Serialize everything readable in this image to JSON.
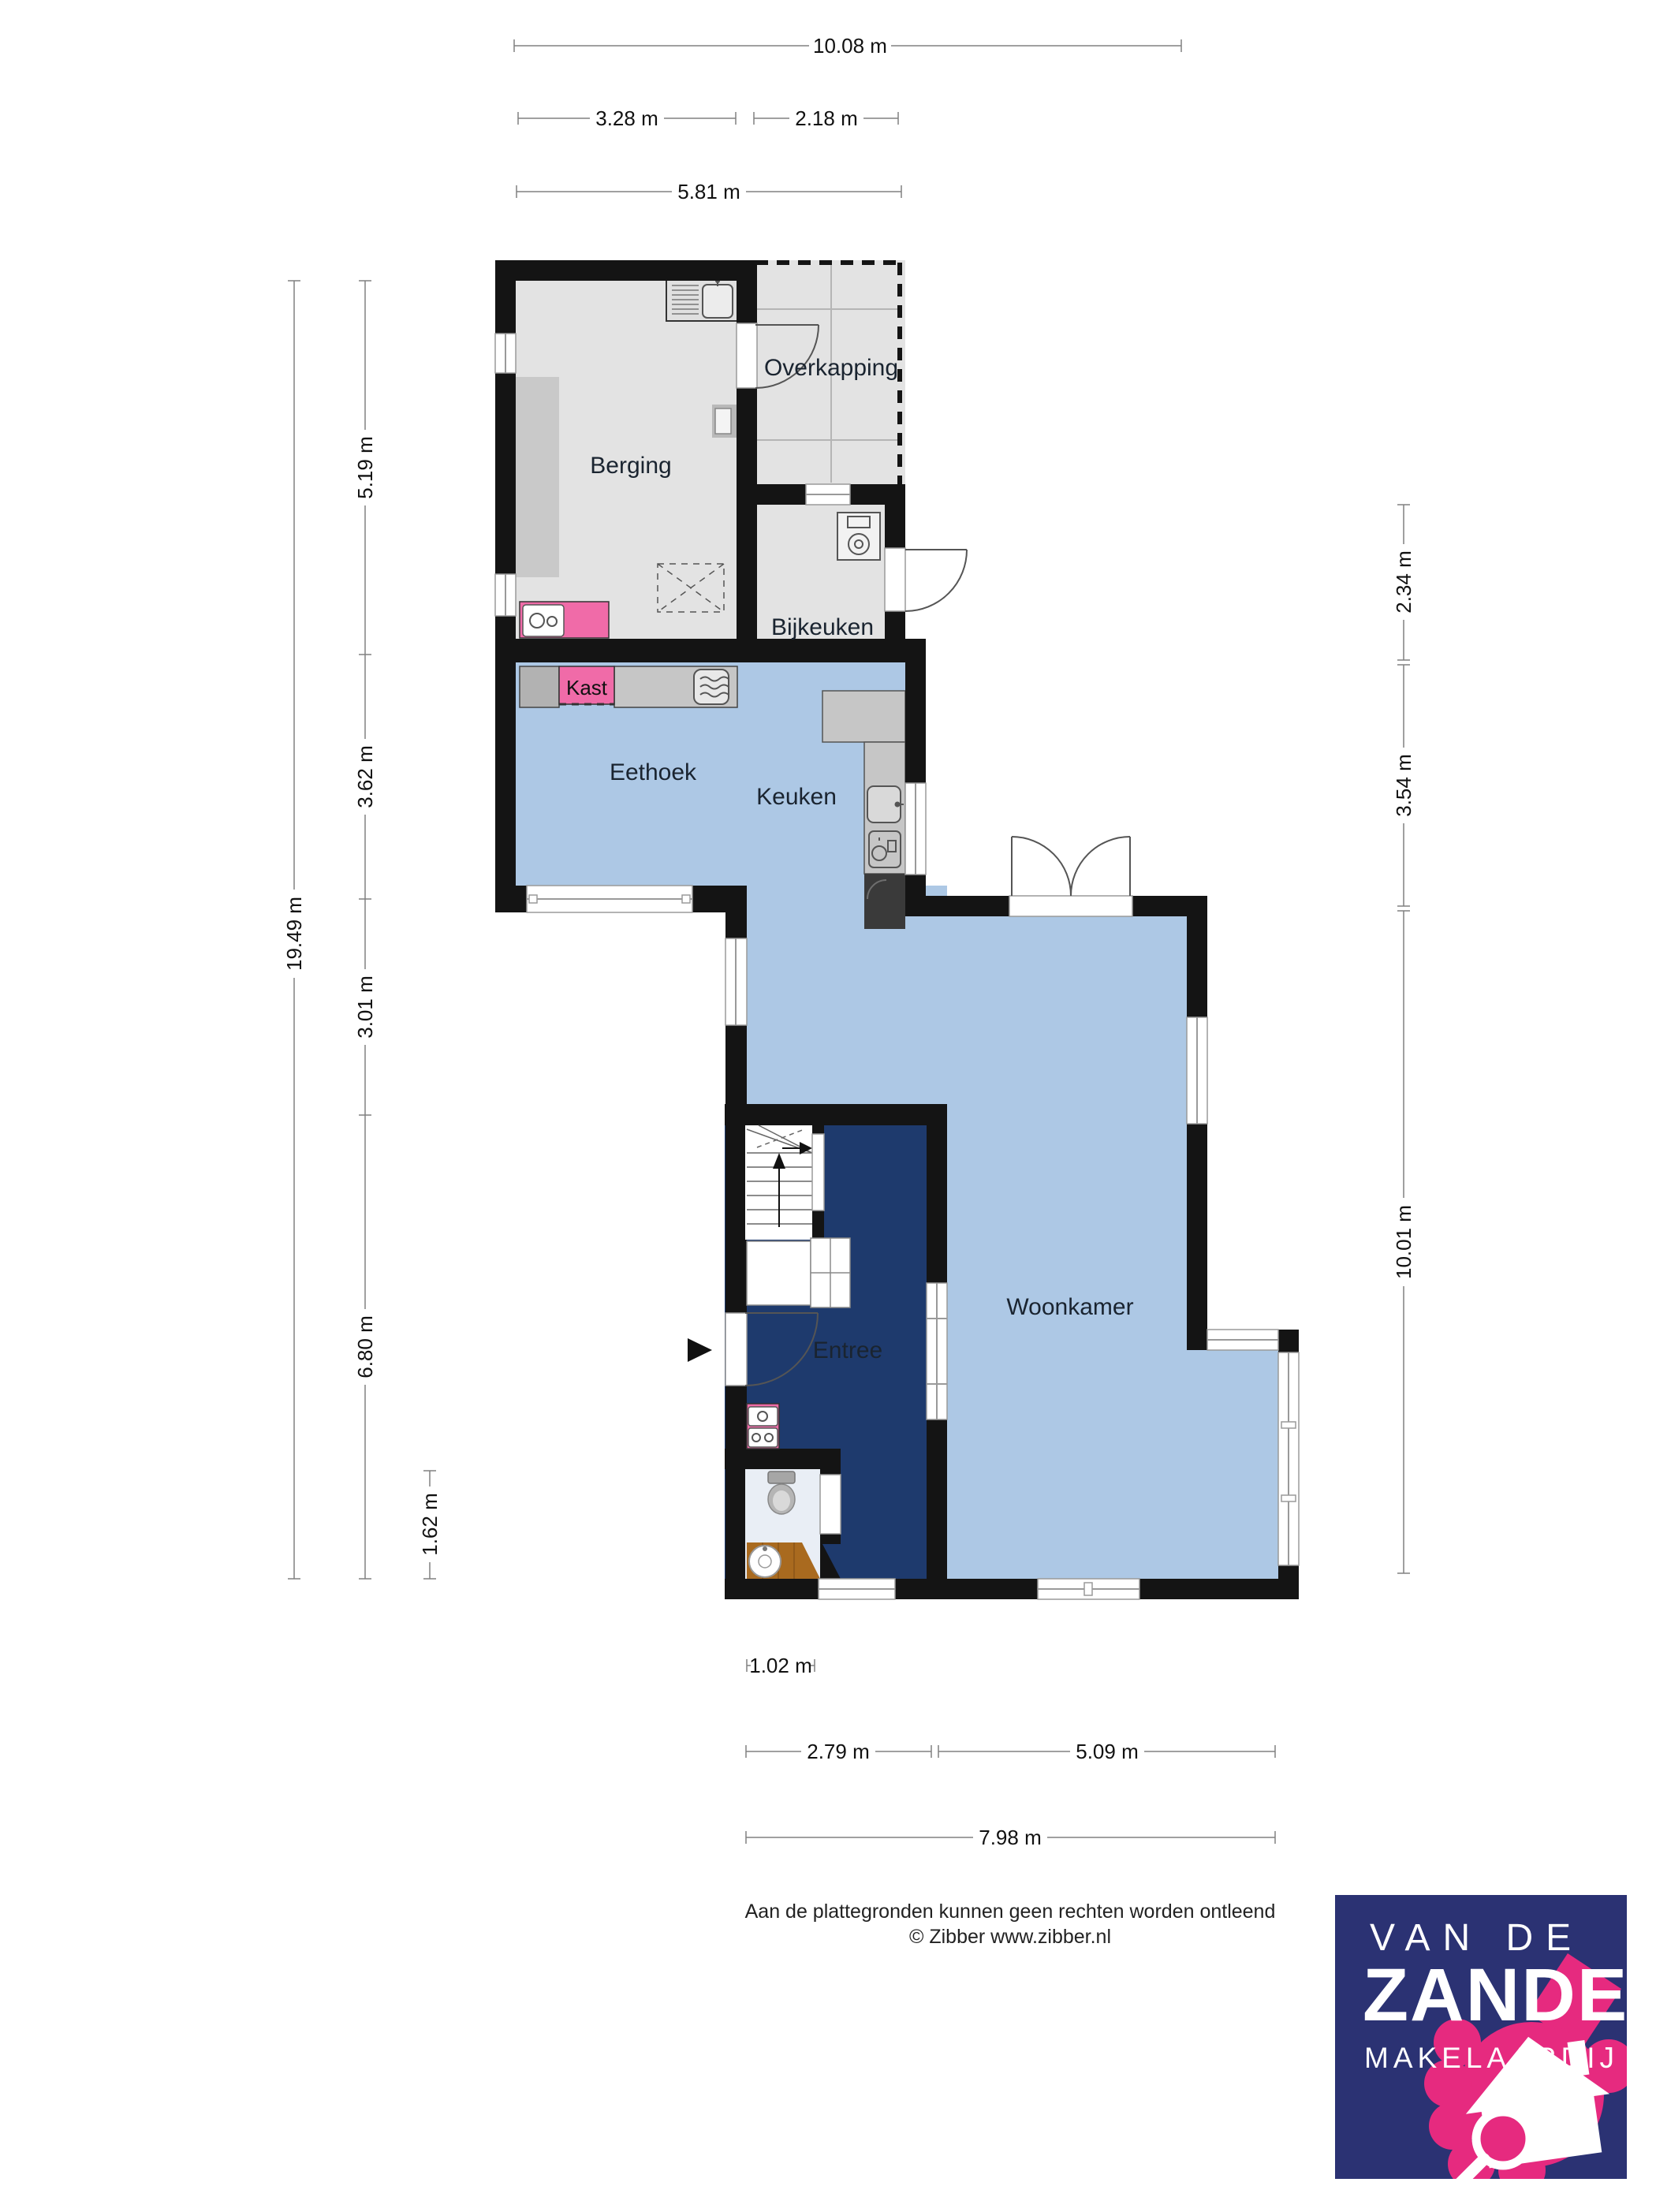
{
  "plan": {
    "rooms": [
      {
        "id": "overkapping",
        "label": "Overkapping"
      },
      {
        "id": "berging",
        "label": "Berging"
      },
      {
        "id": "bijkeuken",
        "label": "Bijkeuken"
      },
      {
        "id": "kast",
        "label": "Kast"
      },
      {
        "id": "eethoek",
        "label": "Eethoek"
      },
      {
        "id": "keuken",
        "label": "Keuken"
      },
      {
        "id": "entree",
        "label": "Entree"
      },
      {
        "id": "woonkamer",
        "label": "Woonkamer"
      }
    ]
  },
  "dimensions": {
    "top": [
      {
        "label": "10.08 m"
      },
      {
        "label": "3.28 m"
      },
      {
        "label": "2.18 m"
      },
      {
        "label": "5.81 m"
      }
    ],
    "left": [
      {
        "label": "19.49 m"
      },
      {
        "label": "5.19 m"
      },
      {
        "label": "3.62 m"
      },
      {
        "label": "3.01 m"
      },
      {
        "label": "6.80 m"
      },
      {
        "label": "1.62 m"
      }
    ],
    "right": [
      {
        "label": "2.34 m"
      },
      {
        "label": "3.54 m"
      },
      {
        "label": "10.01 m"
      }
    ],
    "bottom": [
      {
        "label": "1.02 m"
      },
      {
        "label": "2.79 m"
      },
      {
        "label": "5.09 m"
      },
      {
        "label": "7.98 m"
      }
    ]
  },
  "footer": {
    "disclaimer": "Aan de plattegronden kunnen geen rechten worden ontleend",
    "copyright": "© Zibber www.zibber.nl"
  },
  "logo": {
    "line1": "VAN DE",
    "line2": "ZANDE",
    "line3": "MAKELAARDIJ"
  },
  "colors": {
    "wall": "#141414",
    "floor_gray": "#e3e3e3",
    "floor_blue": "#adc8e5",
    "floor_navy": "#1e3a6d",
    "floor_toilet": "#e9eef5",
    "accent_pink": "#f06ba8",
    "wood": "#a96a1f",
    "logo_navy": "#2b3273",
    "logo_pink": "#e62a7f"
  }
}
